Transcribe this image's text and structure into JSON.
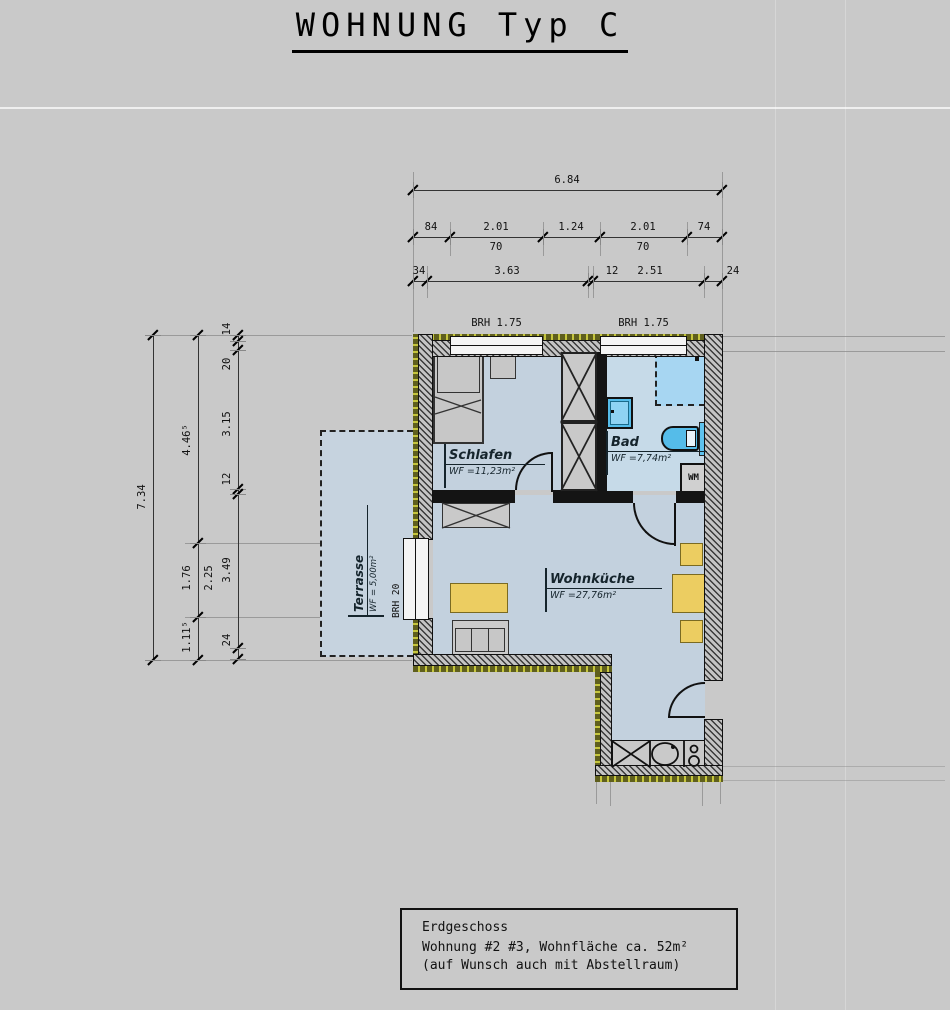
{
  "title": {
    "text": "WOHNUNG Typ C"
  },
  "info_box": {
    "line1": "Erdgeschoss",
    "line2": "Wohnung #2 #3, Wohnfläche ca. 52m²",
    "line3": "(auf Wunsch auch mit Abstellraum)"
  },
  "rooms": {
    "schlafen": {
      "name": "Schlafen",
      "area": "WF =11,23m²"
    },
    "bad": {
      "name": "Bad",
      "area": "WF =7,74m²"
    },
    "wohnkueche": {
      "name": "Wohnküche",
      "area": "WF =27,76m²"
    },
    "terrasse": {
      "name": "Terrasse",
      "area": "WF = 5,00m²"
    }
  },
  "annotations": {
    "window1_brh": "BRH  1.75",
    "window2_brh": "BRH  1.75",
    "terrace_door_brh": "BRH  20",
    "washing_machine": "WM"
  },
  "dimensions": {
    "chains": [
      {
        "orient": "h",
        "y": 190,
        "x1": 413,
        "x2": 722,
        "ticks": [
          413,
          722
        ],
        "labels": [
          {
            "x": 567,
            "side": "above",
            "text": "6.84"
          }
        ]
      },
      {
        "orient": "h",
        "y": 237,
        "x1": 413,
        "x2": 722,
        "ticks": [
          413,
          450,
          543,
          600,
          687,
          722
        ],
        "labels": [
          {
            "x": 431,
            "side": "above",
            "text": "84"
          },
          {
            "x": 496,
            "side": "above",
            "text": "2.01"
          },
          {
            "x": 571,
            "side": "above",
            "text": "1.24"
          },
          {
            "x": 643,
            "side": "above",
            "text": "2.01"
          },
          {
            "x": 704,
            "side": "above",
            "text": "74"
          },
          {
            "x": 496,
            "side": "below",
            "text": "70"
          },
          {
            "x": 643,
            "side": "below",
            "text": "70"
          }
        ]
      },
      {
        "orient": "h",
        "y": 281,
        "x1": 413,
        "x2": 722,
        "ticks": [
          413,
          427,
          588,
          593,
          704,
          722
        ],
        "labels": [
          {
            "x": 419,
            "side": "above",
            "text": "34"
          },
          {
            "x": 507,
            "side": "above",
            "text": "3.63"
          },
          {
            "x": 612,
            "side": "above",
            "text": "12"
          },
          {
            "x": 650,
            "side": "above",
            "text": "2.51"
          },
          {
            "x": 733,
            "side": "above",
            "text": "24"
          }
        ]
      },
      {
        "orient": "v",
        "x": 153,
        "y1": 335,
        "y2": 660,
        "ticks": [
          335,
          660
        ],
        "labels": [
          {
            "y": 497,
            "side": "left",
            "text": "7.34"
          }
        ]
      },
      {
        "orient": "v",
        "x": 198,
        "y1": 335,
        "y2": 660,
        "ticks": [
          335,
          543,
          617,
          660
        ],
        "labels": [
          {
            "y": 440,
            "side": "left",
            "text": "4.46⁵"
          },
          {
            "y": 578,
            "side": "left",
            "text": "1.76"
          },
          {
            "y": 578,
            "side": "right",
            "text": "2.25"
          },
          {
            "y": 637,
            "side": "left",
            "text": "1.11⁵"
          }
        ]
      },
      {
        "orient": "v",
        "x": 238,
        "y1": 335,
        "y2": 659,
        "ticks": [
          335,
          341,
          350,
          489,
          494,
          648,
          659
        ],
        "labels": [
          {
            "y": 329,
            "side": "left",
            "text": "14"
          },
          {
            "y": 364,
            "side": "left",
            "text": "20"
          },
          {
            "y": 424,
            "side": "left",
            "text": "3.15"
          },
          {
            "y": 479,
            "side": "left",
            "text": "12"
          },
          {
            "y": 570,
            "side": "left",
            "text": "3.49"
          },
          {
            "y": 640,
            "side": "left",
            "text": "24"
          }
        ]
      }
    ]
  },
  "colors": {
    "background": "#c9c9c9",
    "floor": "#c3d1de",
    "floor_bath": "#c6dae8",
    "terrace": "#c6d3df",
    "fixture_blue": "#55bce9",
    "shower_blue": "#a7d6f2",
    "furniture_yellow": "#eccd61",
    "insulation_olive": "#5f5f1d"
  }
}
